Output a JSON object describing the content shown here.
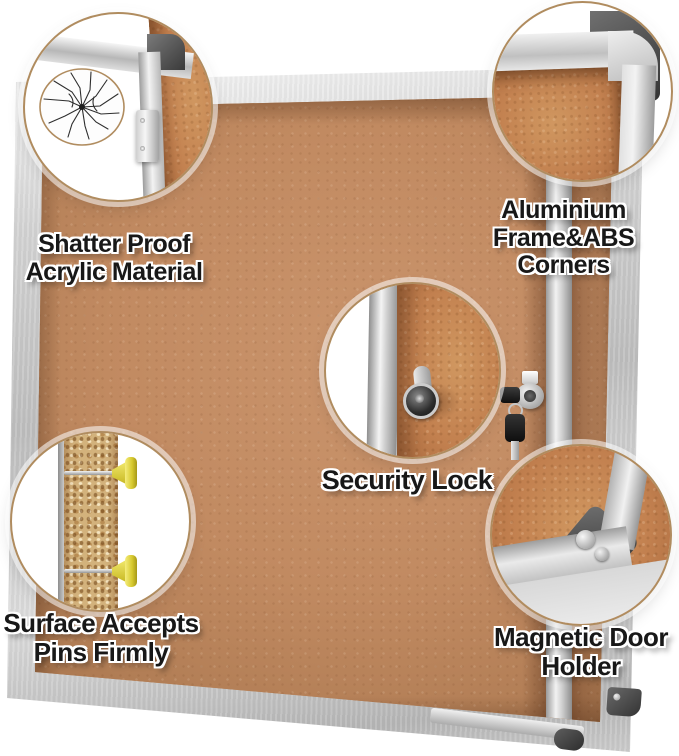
{
  "product": {
    "name": "Lockable cork notice board with aluminium frame",
    "view": "annotated product feature image"
  },
  "callouts": {
    "shatter": {
      "line1": "Shatter Proof",
      "line2": "Acrylic Material"
    },
    "aluminium": {
      "line1": "Aluminium",
      "line2": "Frame&ABS Corners"
    },
    "security": {
      "line1": "Security Lock"
    },
    "pins": {
      "line1": "Surface Accepts",
      "line2": "Pins Firmly"
    },
    "magnetic": {
      "line1": "Magnetic Door",
      "line2": "Holder"
    }
  },
  "graphics": {
    "icons": [
      "shatter-crack-icon",
      "hinge-icon",
      "abs-corner-icon",
      "lock-cylinder-icon",
      "push-pin-icon",
      "magnet-dot-icon",
      "key-icon"
    ]
  },
  "colors": {
    "background": "#ffffff",
    "cork": "#c18a61",
    "cork_zoom": "#c2804f",
    "frame_silver": "#d4d4d4",
    "abs_corner_dark": "#3a3a3a",
    "circle_border": "#b08c5f",
    "pin_yellow": "#e0d434",
    "label_text": "#181818"
  }
}
